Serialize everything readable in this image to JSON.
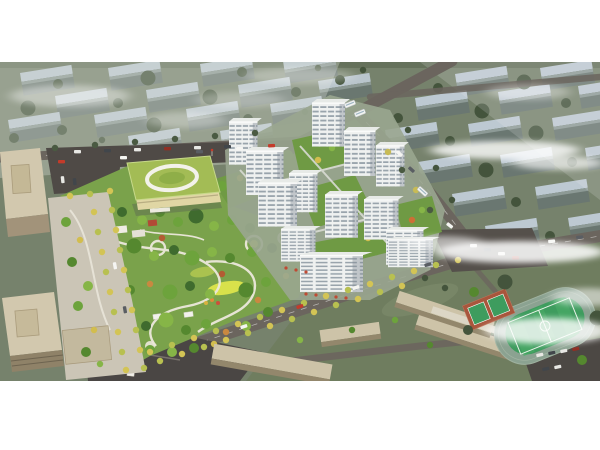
{
  "meta": {
    "alt": "Aerial rendering of a residential master plan: white high-rise towers around a central landscaped park, a green-roof kindergarten, beige office towers on the left, a school campus with running track and sports field at lower right, tree-lined boulevards, and rows of muted apartment blocks fading into haze in the background."
  },
  "scene": {
    "regions": {
      "background_blocks": "hazy low-rise apartment block rows",
      "residential_towers": "white residential tower cluster",
      "central_park": "landscaped park with winding paths",
      "kindergarten": "green-roof kindergarten",
      "office_towers": "beige office towers and plaza",
      "school_campus": "school buildings with sports field",
      "boulevards": "tree-lined streets"
    },
    "palette": {
      "page_bg": "#ffffff",
      "terrain": "#76826c",
      "terrain_light": "#96a18c",
      "slab_roof": "#bdc9d2",
      "slab_face": "#6a7771",
      "bg_tree": "#44543c",
      "road": "#6b655e",
      "road_dark": "#4f4a46",
      "park_green": "#7aa24b",
      "lawn_yellow": "#d8e14b",
      "path_light": "#ece8dc",
      "tower_face": "#eff1f0",
      "tower_stripe": "#99a4ac",
      "tower_roof": "#e7eae7",
      "kindergarten_roof": "#a3bc55",
      "kindergarten_wall": "#e0d6a4",
      "office_beige": "#d2c8ae",
      "school_beige": "#cdc3a8",
      "pitch_green": "#3e9c5e",
      "track_ring": "#8ba291",
      "court_red": "#a8563c",
      "tree_yellow": "#d3c455",
      "cloud": "#ffffff"
    }
  }
}
